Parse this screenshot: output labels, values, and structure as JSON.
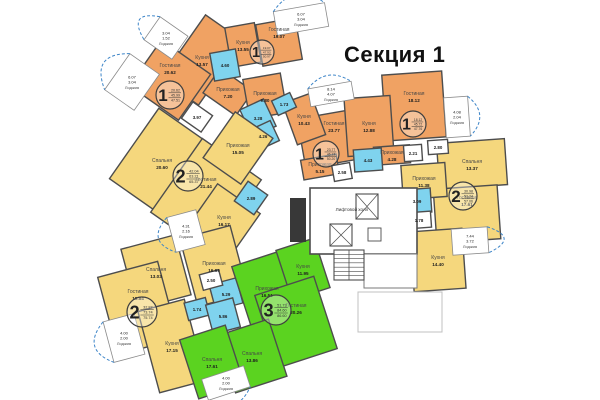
{
  "title": "Секция 1",
  "labels": {
    "loggia": "Лоджия",
    "elevator_hall": "Лифтовой холл"
  },
  "colors": {
    "apt1": "#f0a263",
    "apt2": "#f5d77d",
    "apt3": "#5bd320",
    "wet": "#7fd3ee",
    "white": "#ffffff",
    "wall": "#4d4d4d",
    "loggia_arc": "#3d85c8",
    "faint": "#c0c0c0"
  },
  "apartments": [
    {
      "id": "1A",
      "number": "1",
      "summary": [
        "20.62",
        "45.99",
        "47.51"
      ],
      "circle": {
        "x": 170,
        "y": 95,
        "r": 14
      }
    },
    {
      "id": "1B",
      "number": "1",
      "summary": [
        "19.07",
        "47.93",
        "50.97"
      ],
      "circle": {
        "x": 262,
        "y": 52,
        "r": 12
      }
    },
    {
      "id": "1C",
      "number": "1",
      "summary": [
        "23.77",
        "46.13",
        "50.20"
      ],
      "circle": {
        "x": 326,
        "y": 154,
        "r": 13
      }
    },
    {
      "id": "1D",
      "number": "1",
      "summary": [
        "18.12",
        "45.72",
        "47.76"
      ],
      "circle": {
        "x": 413,
        "y": 124,
        "r": 13
      }
    },
    {
      "id": "2A",
      "number": "2",
      "summary": [
        "42.04",
        "63.21",
        "65.37"
      ],
      "circle": {
        "x": 188,
        "y": 176,
        "r": 15
      }
    },
    {
      "id": "2B",
      "number": "2",
      "summary": [
        "32.87",
        "73.74",
        "75.74"
      ],
      "circle": {
        "x": 142,
        "y": 312,
        "r": 15
      }
    },
    {
      "id": "2C",
      "number": "2",
      "summary": [
        "30.98",
        "53.34",
        "57.06"
      ],
      "circle": {
        "x": 463,
        "y": 196,
        "r": 14
      }
    },
    {
      "id": "3",
      "number": "3",
      "summary": [
        "51.73",
        "84.60",
        "86.60"
      ],
      "circle": {
        "x": 276,
        "y": 310,
        "r": 15
      }
    }
  ],
  "rooms": [
    {
      "apt": "1A",
      "name": "Кухня",
      "area": "13.57",
      "cx": 202,
      "cy": 60,
      "w": 46,
      "h": 78,
      "rot": 35
    },
    {
      "apt": "1A",
      "name": "Гостиная",
      "area": "20.62",
      "cx": 170,
      "cy": 80,
      "w": 60,
      "h": 56,
      "rot": 35,
      "ldy": -12
    },
    {
      "apt": "1A",
      "name": "Прихожая",
      "area": "7.20",
      "cx": 228,
      "cy": 92,
      "w": 40,
      "h": 30,
      "rot": 35
    },
    {
      "apt": "1A",
      "name": "",
      "area": "3.97",
      "cx": 197,
      "cy": 117,
      "w": 24,
      "h": 20,
      "rot": 35,
      "white": true
    },
    {
      "apt": "1B",
      "name": "Кухня",
      "area": "13.55",
      "cx": 243,
      "cy": 45,
      "w": 30,
      "h": 40,
      "rot": -10
    },
    {
      "apt": "1B",
      "name": "Гостиная",
      "area": "19.07",
      "cx": 279,
      "cy": 42,
      "w": 40,
      "h": 42,
      "rot": -10,
      "ldy": -10
    },
    {
      "apt": "1B",
      "name": "Прихожая",
      "area": "9.80",
      "cx": 265,
      "cy": 96,
      "w": 38,
      "h": 40,
      "rot": -10
    },
    {
      "apt": "1B",
      "name": "",
      "area": "4.60",
      "cx": 225,
      "cy": 65,
      "w": 26,
      "h": 28,
      "rot": -10,
      "wet": true
    },
    {
      "apt": "1C",
      "name": "Гостиная",
      "area": "23.77",
      "cx": 334,
      "cy": 138,
      "w": 66,
      "h": 50,
      "rot": -10,
      "ldy": -12
    },
    {
      "apt": "1C",
      "name": "Кухня",
      "area": "10.43",
      "cx": 304,
      "cy": 119,
      "w": 30,
      "h": 44,
      "rot": -20
    },
    {
      "apt": "1C",
      "name": "Прихожая",
      "area": "5.15",
      "cx": 320,
      "cy": 167,
      "w": 36,
      "h": 20,
      "rot": -10
    },
    {
      "apt": "1C",
      "name": "",
      "area": "2.58",
      "cx": 342,
      "cy": 172,
      "w": 18,
      "h": 16,
      "rot": -10,
      "white": true
    },
    {
      "apt": "1C",
      "name": "",
      "area": "3.28",
      "cx": 258,
      "cy": 118,
      "w": 26,
      "h": 30,
      "rot": -25,
      "wet": true
    },
    {
      "apt": "1C",
      "name": "",
      "area": "1.73",
      "cx": 284,
      "cy": 104,
      "w": 20,
      "h": 16,
      "rot": -25,
      "wet": true
    },
    {
      "apt": "1C",
      "name": "",
      "area": "4.26",
      "cx": 263,
      "cy": 136,
      "w": 26,
      "h": 22,
      "rot": -25,
      "wet": true
    },
    {
      "apt": "1D",
      "name": "Гостиная",
      "area": "18.12",
      "cx": 414,
      "cy": 106,
      "w": 60,
      "h": 66,
      "rot": -4,
      "ldy": -10
    },
    {
      "apt": "1D",
      "name": "Кухня",
      "area": "12.88",
      "cx": 369,
      "cy": 126,
      "w": 46,
      "h": 58,
      "rot": -4
    },
    {
      "apt": "1D",
      "name": "Прихожая",
      "area": "4.28",
      "cx": 392,
      "cy": 155,
      "w": 36,
      "h": 18,
      "rot": -4
    },
    {
      "apt": "1D",
      "name": "",
      "area": "2.21",
      "cx": 413,
      "cy": 153,
      "w": 18,
      "h": 16,
      "rot": -4,
      "white": true
    },
    {
      "apt": "1D",
      "name": "",
      "area": "4.43",
      "cx": 368,
      "cy": 160,
      "w": 28,
      "h": 22,
      "rot": -4,
      "wet": true
    },
    {
      "apt": "2A",
      "name": "Спальня",
      "area": "20.60",
      "cx": 162,
      "cy": 163,
      "w": 68,
      "h": 86,
      "rot": 35
    },
    {
      "apt": "2A",
      "name": "Гостиная",
      "area": "21.44",
      "cx": 206,
      "cy": 196,
      "w": 72,
      "h": 90,
      "rot": 35,
      "ldy": -14
    },
    {
      "apt": "2A",
      "name": "Прихожая",
      "area": "15.05",
      "cx": 238,
      "cy": 148,
      "w": 46,
      "h": 56,
      "rot": 35
    },
    {
      "apt": "2A",
      "name": "Кухня",
      "area": "16.17",
      "cx": 224,
      "cy": 220,
      "w": 52,
      "h": 52,
      "rot": 35
    },
    {
      "apt": "2A",
      "name": "",
      "area": "2.89",
      "cx": 251,
      "cy": 198,
      "w": 24,
      "h": 24,
      "rot": 35,
      "wet": true
    },
    {
      "apt": "2B",
      "name": "Спальня",
      "area": "13.03",
      "cx": 156,
      "cy": 272,
      "w": 56,
      "h": 62,
      "rot": -15
    },
    {
      "apt": "2B",
      "name": "Гостиная",
      "area": "19.84",
      "cx": 138,
      "cy": 308,
      "w": 62,
      "h": 80,
      "rot": -15,
      "ldy": -14
    },
    {
      "apt": "2B",
      "name": "Кухня",
      "area": "17.15",
      "cx": 172,
      "cy": 346,
      "w": 48,
      "h": 84,
      "rot": -15
    },
    {
      "apt": "2B",
      "name": "Прихожая",
      "area": "16.69",
      "cx": 214,
      "cy": 266,
      "w": 52,
      "h": 70,
      "rot": -15
    },
    {
      "apt": "2B",
      "name": "",
      "area": "5.29",
      "cx": 226,
      "cy": 294,
      "w": 28,
      "h": 26,
      "rot": -15,
      "wet": true
    },
    {
      "apt": "2B",
      "name": "",
      "area": "1.74",
      "cx": 197,
      "cy": 309,
      "w": 22,
      "h": 18,
      "rot": -15,
      "wet": true
    },
    {
      "apt": "2B",
      "name": "",
      "area": "5.86",
      "cx": 223,
      "cy": 316,
      "w": 28,
      "h": 30,
      "rot": -15,
      "wet": true
    },
    {
      "apt": "2B",
      "name": "",
      "area": "2.50",
      "cx": 211,
      "cy": 280,
      "w": 20,
      "h": 16,
      "rot": -15,
      "white": true
    },
    {
      "apt": "2C",
      "name": "Спальня",
      "area": "13.37",
      "cx": 472,
      "cy": 164,
      "w": 68,
      "h": 46,
      "rot": -4
    },
    {
      "apt": "2C",
      "name": "Гостиная",
      "area": "17.61",
      "cx": 467,
      "cy": 214,
      "w": 64,
      "h": 54,
      "rot": -4,
      "ldy": -14
    },
    {
      "apt": "2C",
      "name": "Прихожая",
      "area": "11.38",
      "cx": 424,
      "cy": 181,
      "w": 44,
      "h": 34,
      "rot": -4
    },
    {
      "apt": "2C",
      "name": "Кухня",
      "area": "14.40",
      "cx": 438,
      "cy": 260,
      "w": 52,
      "h": 60,
      "rot": -4
    },
    {
      "apt": "2C",
      "name": "",
      "area": "3.09",
      "cx": 417,
      "cy": 201,
      "w": 28,
      "h": 24,
      "rot": -4,
      "wet": true
    },
    {
      "apt": "2C",
      "name": "",
      "area": "1.78",
      "cx": 419,
      "cy": 220,
      "w": 24,
      "h": 16,
      "rot": -4,
      "white": true
    },
    {
      "apt": "2C",
      "name": "",
      "area": "2.80",
      "cx": 438,
      "cy": 147,
      "w": 20,
      "h": 14,
      "rot": -4,
      "white": true
    },
    {
      "apt": "3",
      "name": "Прихожая",
      "area": "16.51",
      "cx": 267,
      "cy": 291,
      "w": 52,
      "h": 68,
      "rot": -18
    },
    {
      "apt": "3",
      "name": "Кухня",
      "area": "11.95",
      "cx": 303,
      "cy": 269,
      "w": 40,
      "h": 52,
      "rot": -18
    },
    {
      "apt": "3",
      "name": "Гостиная",
      "area": "20.26",
      "cx": 296,
      "cy": 322,
      "w": 62,
      "h": 76,
      "rot": -18,
      "ldy": -14
    },
    {
      "apt": "3",
      "name": "Спальня",
      "area": "13.86",
      "cx": 252,
      "cy": 356,
      "w": 54,
      "h": 60,
      "rot": -18
    },
    {
      "apt": "3",
      "name": "Спальня",
      "area": "17.61",
      "cx": 212,
      "cy": 362,
      "w": 48,
      "h": 62,
      "rot": -18
    }
  ],
  "loggias": [
    {
      "apt": "1A",
      "values": [
        "3.04",
        "1.52"
      ],
      "cx": 166,
      "cy": 38,
      "w": 34,
      "h": 28,
      "rot": 35,
      "side": "left"
    },
    {
      "apt": "1A",
      "values": [
        "6.07",
        "3.04"
      ],
      "cx": 132,
      "cy": 82,
      "w": 36,
      "h": 44,
      "rot": 35,
      "side": "left"
    },
    {
      "apt": "1B",
      "values": [
        "6.07",
        "3.04"
      ],
      "cx": 301,
      "cy": 19,
      "w": 52,
      "h": 24,
      "rot": -10,
      "side": "top"
    },
    {
      "apt": "1C",
      "values": [
        "8.14",
        "4.07"
      ],
      "cx": 331,
      "cy": 94,
      "w": 44,
      "h": 18,
      "rot": -10,
      "side": "top"
    },
    {
      "apt": "1D",
      "values": [
        "4.08",
        "2.04"
      ],
      "cx": 457,
      "cy": 117,
      "w": 24,
      "h": 40,
      "rot": -4,
      "side": "right"
    },
    {
      "apt": "2C",
      "values": [
        "7.44",
        "3.72"
      ],
      "cx": 470,
      "cy": 241,
      "w": 36,
      "h": 26,
      "rot": -4,
      "side": "right"
    },
    {
      "apt": "2A",
      "values": [
        "4.31",
        "2.16"
      ],
      "cx": 186,
      "cy": 231,
      "w": 30,
      "h": 36,
      "rot": -15,
      "side": "left"
    },
    {
      "apt": "2B",
      "values": [
        "4.00",
        "2.00"
      ],
      "cx": 124,
      "cy": 338,
      "w": 32,
      "h": 42,
      "rot": -15,
      "side": "left"
    },
    {
      "apt": "3",
      "values": [
        "4.00",
        "2.00"
      ],
      "cx": 226,
      "cy": 383,
      "w": 44,
      "h": 22,
      "rot": -18,
      "side": "bottom"
    }
  ],
  "core": {
    "hall": {
      "x": 310,
      "y": 188,
      "w": 107,
      "h": 66
    },
    "hall_label": {
      "x": 352,
      "y": 211
    },
    "elevators": [
      {
        "x": 356,
        "y": 194,
        "w": 22,
        "h": 25
      },
      {
        "x": 330,
        "y": 224,
        "w": 22,
        "h": 22
      }
    ],
    "duct": {
      "x": 368,
      "y": 228,
      "w": 13,
      "h": 13
    },
    "shaft": {
      "x": 290,
      "y": 198,
      "w": 16,
      "h": 44
    },
    "stairs": {
      "x": 334,
      "y": 250,
      "w": 30,
      "h": 30,
      "treads": 6
    },
    "annex": {
      "x": 364,
      "y": 254,
      "w": 53,
      "h": 34
    },
    "terrace": {
      "x": 358,
      "y": 292,
      "w": 84,
      "h": 40
    }
  }
}
